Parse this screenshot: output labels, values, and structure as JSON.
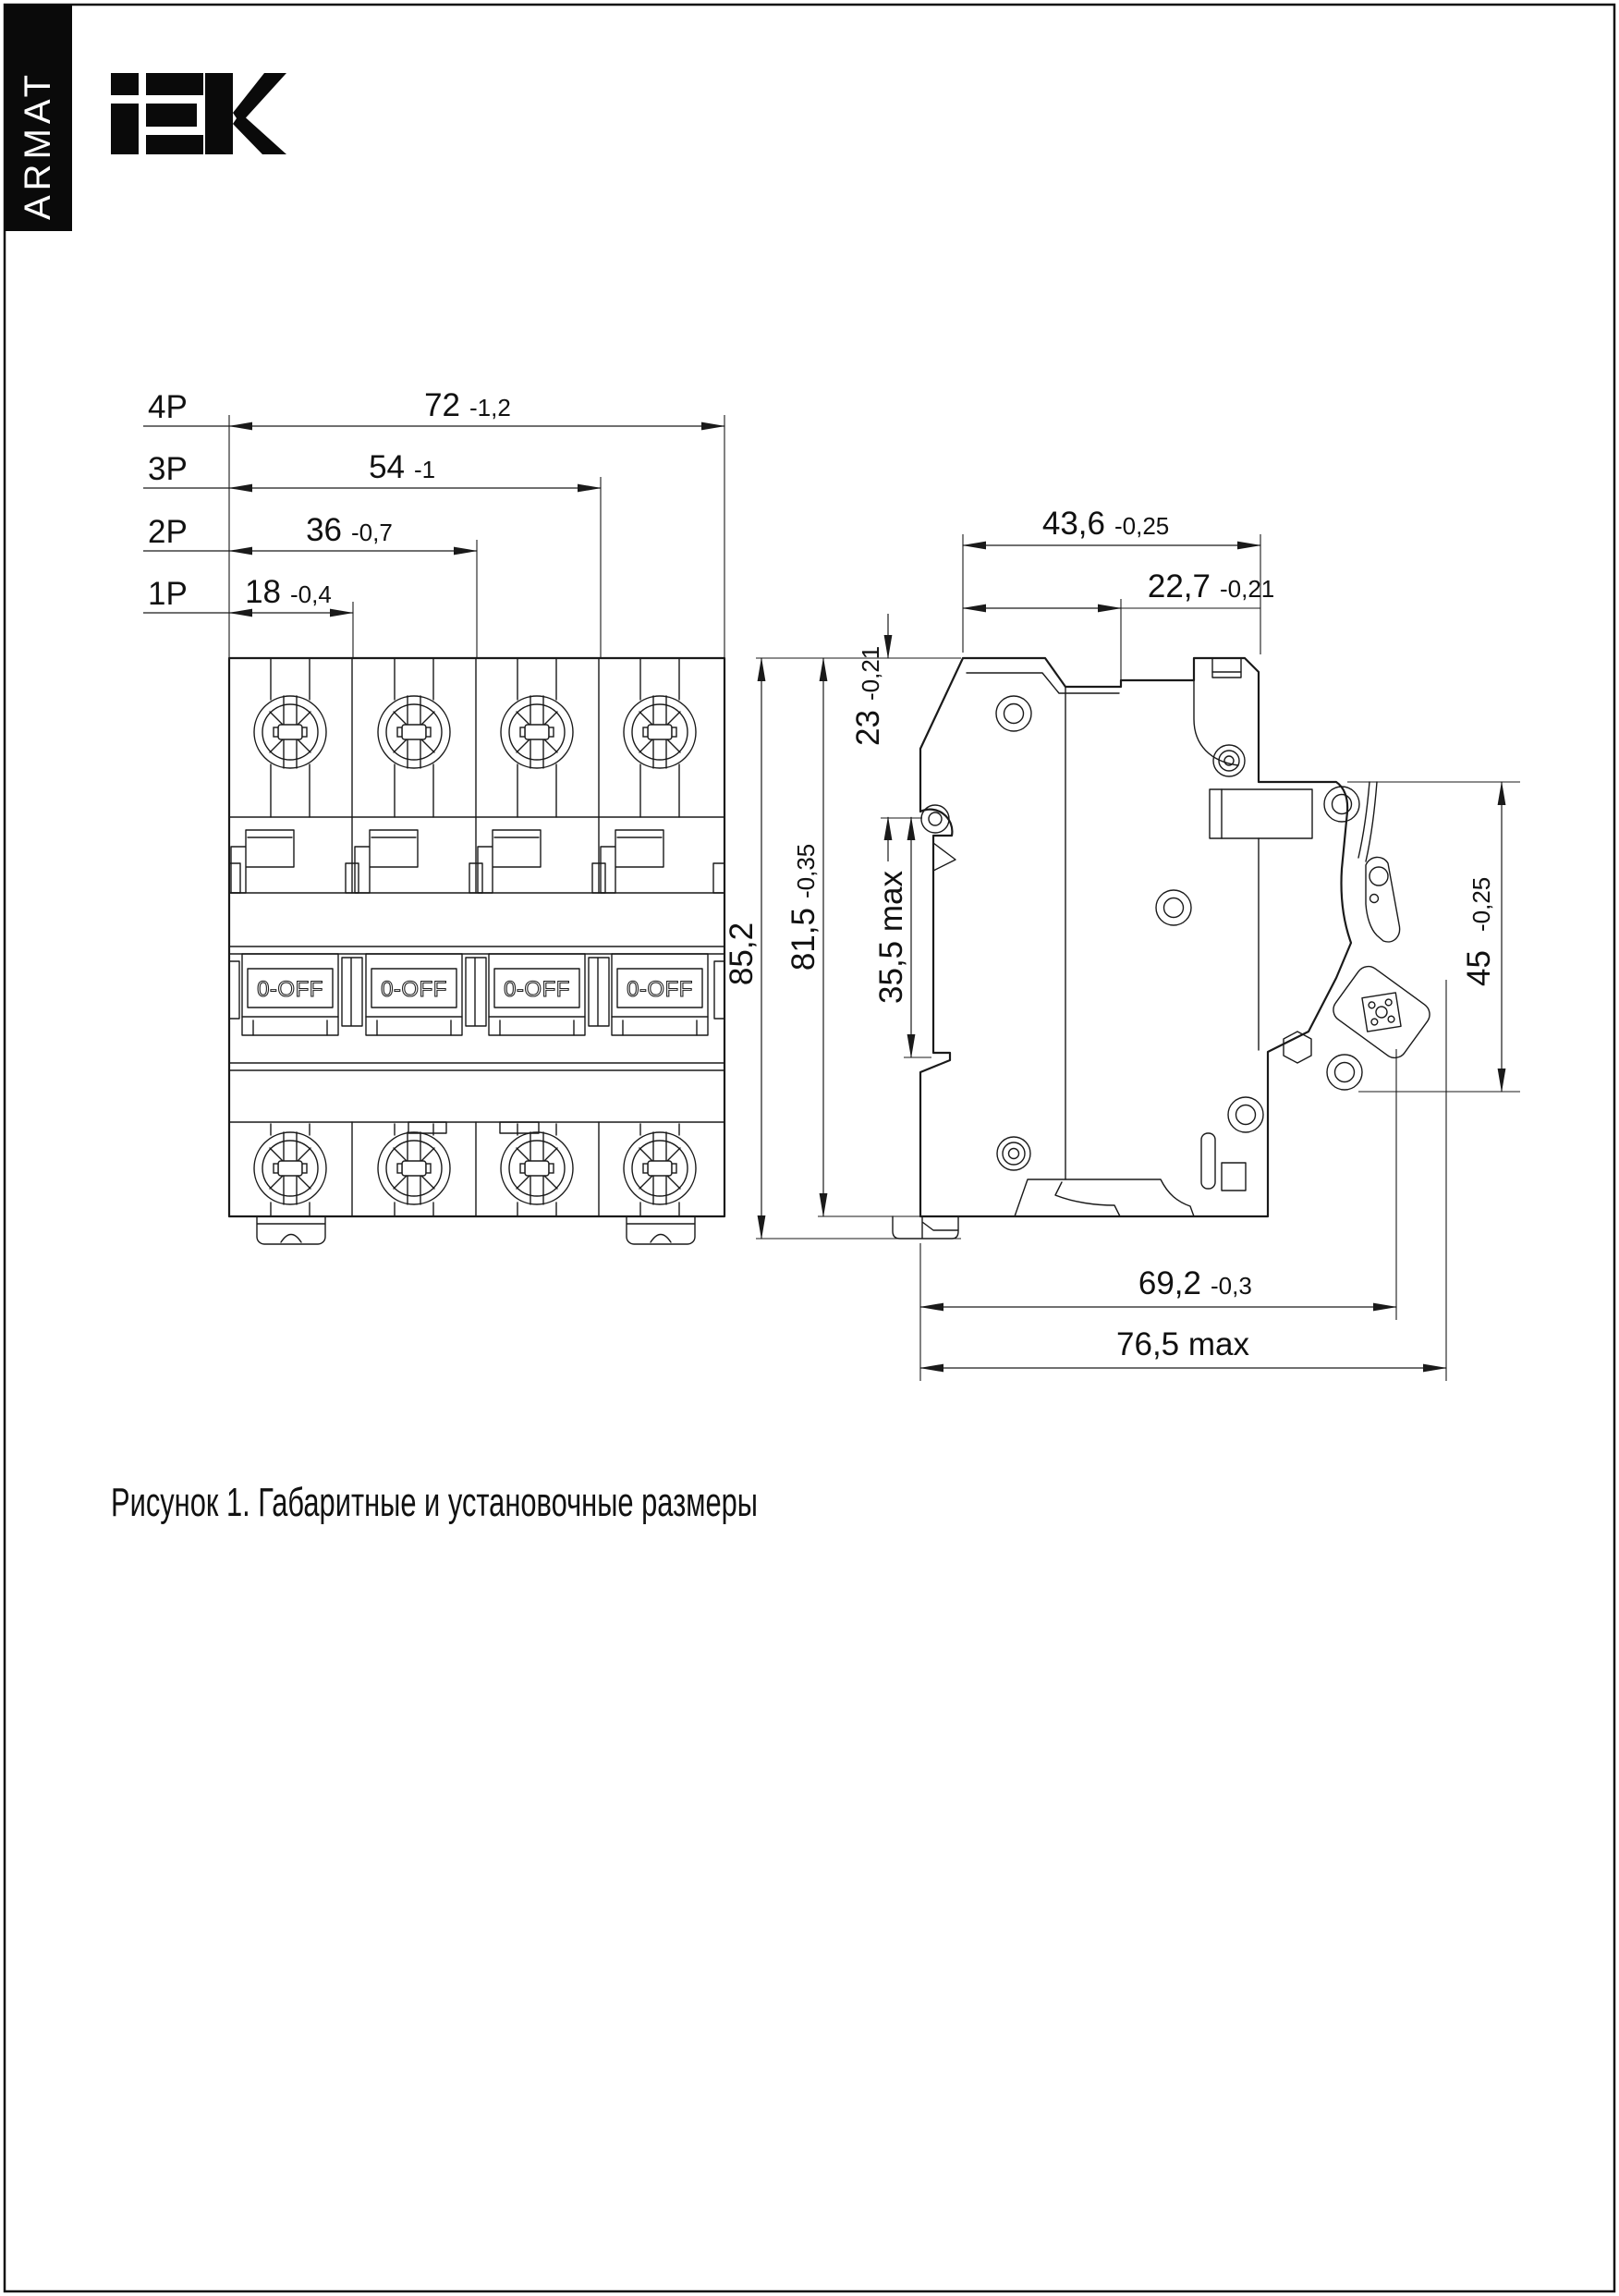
{
  "brand": {
    "logo": "iEK",
    "series": "ARMAT"
  },
  "figure": {
    "caption": "Рисунок 1. Габаритные и установочные размеры"
  },
  "front_view": {
    "handle_label": "0-OFF",
    "dims": [
      {
        "label": "4P",
        "value": "72",
        "tol": "-1,2"
      },
      {
        "label": "3P",
        "value": "54",
        "tol": "-1"
      },
      {
        "label": "2P",
        "value": "36",
        "tol": "-0,7"
      },
      {
        "label": "1P",
        "value": "18",
        "tol": "-0,4"
      }
    ]
  },
  "side_view": {
    "dims": {
      "width_top": {
        "value": "43,6",
        "tol": "-0,25"
      },
      "width_upper": {
        "value": "22,7",
        "tol": "-0,21"
      },
      "height_total": {
        "value": "85,2"
      },
      "height_body": {
        "value": "81,5",
        "tol": "-0,35"
      },
      "top_to_rail": {
        "value": "23",
        "tol": "-0,21"
      },
      "rail_zone": {
        "value": "35,5 max"
      },
      "front_height": {
        "value": "45",
        "tol": "-0,25"
      },
      "depth_body": {
        "value": "69,2",
        "tol": "-0,3"
      },
      "depth_max": {
        "value": "76,5 max"
      }
    }
  }
}
